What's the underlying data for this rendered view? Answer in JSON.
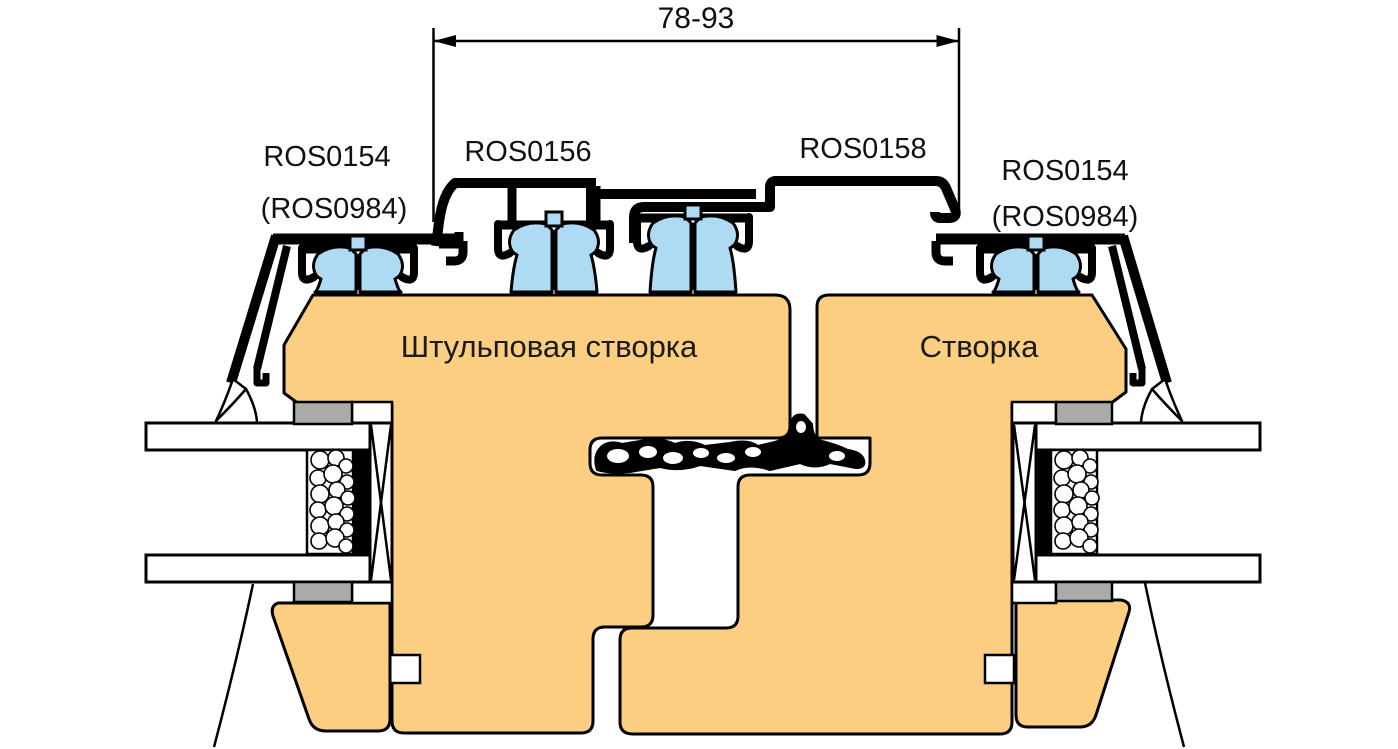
{
  "dimension": {
    "value": "78-93"
  },
  "labels": {
    "left_cap": "ROS0154",
    "left_cap_alt": "(ROS0984)",
    "mid_left": "ROS0156",
    "mid_right": "ROS0158",
    "right_cap": "ROS0154",
    "right_cap_alt": "(ROS0984)"
  },
  "sashes": {
    "left": "Штульповая створка",
    "right": "Створка"
  },
  "palette": {
    "wood": "#FBCE82",
    "clip_blue": "#AEDAF4",
    "gasket_gray": "#ABABAB",
    "outline": "#000000",
    "glass_white": "#FFFFFF"
  }
}
